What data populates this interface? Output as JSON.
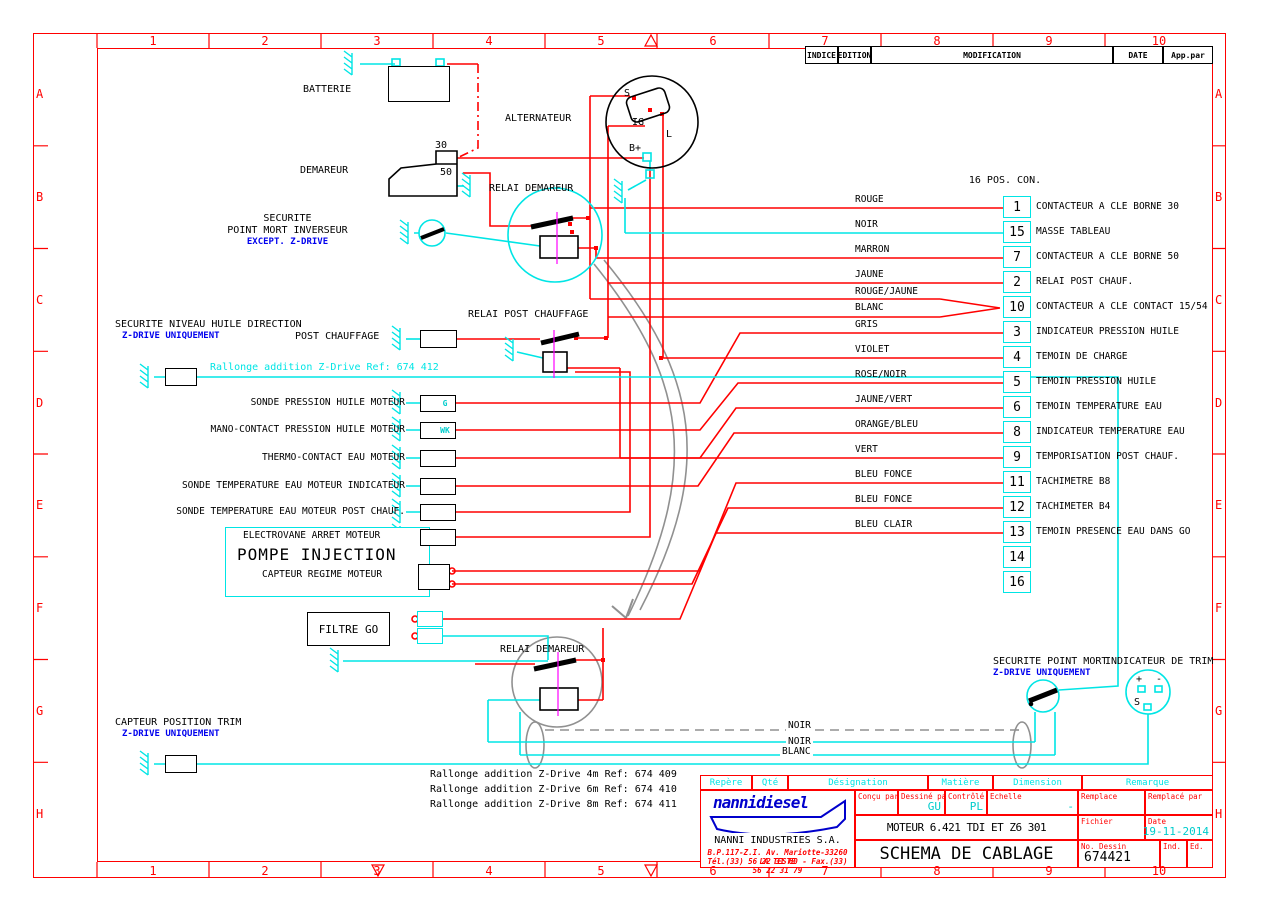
{
  "colors": {
    "wire_red": "#ff0000",
    "wire_cyan": "#00e5e5",
    "note_blue": "#0000ee",
    "accent_magenta": "#ff00ff",
    "gray": "#909090"
  },
  "border": {
    "cols": [
      "1",
      "2",
      "3",
      "4",
      "5",
      "6",
      "7",
      "8",
      "9",
      "10"
    ],
    "rows": [
      "A",
      "B",
      "C",
      "D",
      "E",
      "F",
      "G",
      "H"
    ]
  },
  "revision": {
    "indice": "INDICE",
    "edition": "EDITION",
    "modification": "MODIFICATION",
    "date": "DATE",
    "app_par": "App.par"
  },
  "labels": {
    "batterie": "BATTERIE",
    "alternateur": "ALTERNATEUR",
    "demareur": "DEMAREUR",
    "t30": "30",
    "t50": "50",
    "relai_demareur": "RELAI DEMAREUR",
    "securite_pm1": "SECURITE",
    "securite_pm2": "POINT MORT INVERSEUR",
    "securite_pm_note": "EXCEPT. Z-DRIVE",
    "post_chauffage": "POST CHAUFFAGE",
    "relai_post_chauffage": "RELAI POST CHAUFFAGE",
    "niveau_huile": "SECURITE NIVEAU HUILE DIRECTION",
    "niveau_note": "Z-DRIVE UNIQUEMENT",
    "rallonge412": "Rallonge addition  Z-Drive  Ref: 674 412",
    "pompe_electrovane": "ELECTROVANE ARRET MOTEUR",
    "pompe_title": "POMPE INJECTION",
    "pompe_capteur": "CAPTEUR REGIME MOTEUR",
    "filtre_go": "FILTRE GO",
    "relai_demareur_bas": "RELAI DEMAREUR",
    "securite_pm_bas": "SECURITE POINT MORT",
    "securite_pm_bas_note": "Z-DRIVE UNIQUEMENT",
    "indicateur_trim": "INDICATEUR DE TRIM",
    "capteur_trim": "CAPTEUR POSITION TRIM",
    "capteur_trim_note": "Z-DRIVE UNIQUEMENT",
    "term_s": "S",
    "term_ig": "IG",
    "term_l": "L",
    "term_bplus": "B+",
    "trim_plus": "+",
    "trim_minus": "-",
    "trim_sender": "S"
  },
  "connector": {
    "title": "16 POS. CON.",
    "rows": [
      {
        "pin": "1",
        "wire": "ROUGE",
        "desc": "CONTACTEUR A CLE BORNE 30"
      },
      {
        "pin": "15",
        "wire": "NOIR",
        "desc": "MASSE TABLEAU"
      },
      {
        "pin": "7",
        "wire": "MARRON",
        "desc": "CONTACTEUR A CLE BORNE 50"
      },
      {
        "pin": "2",
        "wire": "JAUNE",
        "desc": "RELAI POST CHAUF."
      },
      {
        "pin": "10",
        "wire": "ROUGE/JAUNE",
        "wire2": "BLANC",
        "desc": "CONTACTEUR A CLE CONTACT 15/54"
      },
      {
        "pin": "3",
        "wire": "GRIS",
        "desc": "INDICATEUR PRESSION HUILE"
      },
      {
        "pin": "4",
        "wire": "VIOLET",
        "desc": "TEMOIN DE CHARGE"
      },
      {
        "pin": "5",
        "wire": "ROSE/NOIR",
        "desc": "TEMOIN PRESSION HUILE"
      },
      {
        "pin": "6",
        "wire": "JAUNE/VERT",
        "desc": "TEMOIN TEMPERATURE EAU"
      },
      {
        "pin": "8",
        "wire": "ORANGE/BLEU",
        "desc": "INDICATEUR TEMPERATURE EAU"
      },
      {
        "pin": "9",
        "wire": "VERT",
        "desc": "TEMPORISATION POST CHAUF."
      },
      {
        "pin": "11",
        "wire": "BLEU FONCE",
        "desc": "TACHIMETRE B8"
      },
      {
        "pin": "12",
        "wire": "BLEU FONCE",
        "desc": "TACHIMETER B4"
      },
      {
        "pin": "13",
        "wire": "BLEU CLAIR",
        "desc": "TEMOIN PRESENCE EAU DANS GO"
      },
      {
        "pin": "14",
        "wire": "",
        "desc": ""
      },
      {
        "pin": "16",
        "wire": "",
        "desc": ""
      }
    ]
  },
  "sensors": [
    {
      "label": "SONDE PRESSION HUILE MOTEUR",
      "tag": "G"
    },
    {
      "label": "MANO-CONTACT PRESSION HUILE MOTEUR",
      "tag": "WK"
    },
    {
      "label": "THERMO-CONTACT EAU MOTEUR",
      "tag": ""
    },
    {
      "label": "SONDE TEMPERATURE EAU MOTEUR INDICATEUR",
      "tag": ""
    },
    {
      "label": "SONDE TEMPERATURE EAU MOTEUR POST CHAUF.",
      "tag": ""
    }
  ],
  "bottom_wires": [
    "NOIR",
    "NOIR",
    "BLANC"
  ],
  "rallonges": [
    "Rallonge addition  Z-Drive 4m   Ref: 674 409",
    "Rallonge addition  Z-Drive 6m   Ref: 674 410",
    "Rallonge addition  Z-Drive 8m   Ref: 674 411"
  ],
  "title_block": {
    "col_repere": "Repère",
    "col_qte": "Qté",
    "col_designation": "Désignation",
    "col_matiere": "Matière",
    "col_dimension": "Dimension",
    "col_remarque": "Remarque",
    "logo_text": "nannidiesel",
    "company": "NANNI INDUSTRIES S.A.",
    "address1": "B.P.117-Z.I. Av. Mariotte-33260 LA TESTE",
    "address2": "Tél.(33) 56 22 31 60 - Fax.(33) 56 22 31 79",
    "concu": "Conçu par",
    "dessine": "Dessiné par",
    "dessine_val": "GU",
    "controle": "Contrôlé par",
    "controle_val": "PL",
    "echelle": "Echelle",
    "echelle_val": "-",
    "remplace": "Remplace",
    "remplace_par": "Remplacé par",
    "fichier": "Fichier",
    "date_label": "Date",
    "date_val": "19-11-2014",
    "moteur": "MOTEUR 6.421 TDI ET Z6 301",
    "titre": "SCHEMA DE CABLAGE",
    "no_dessin_label": "No. Dessin",
    "no_dessin": "674421",
    "ind": "Ind.",
    "ed": "Ed."
  }
}
